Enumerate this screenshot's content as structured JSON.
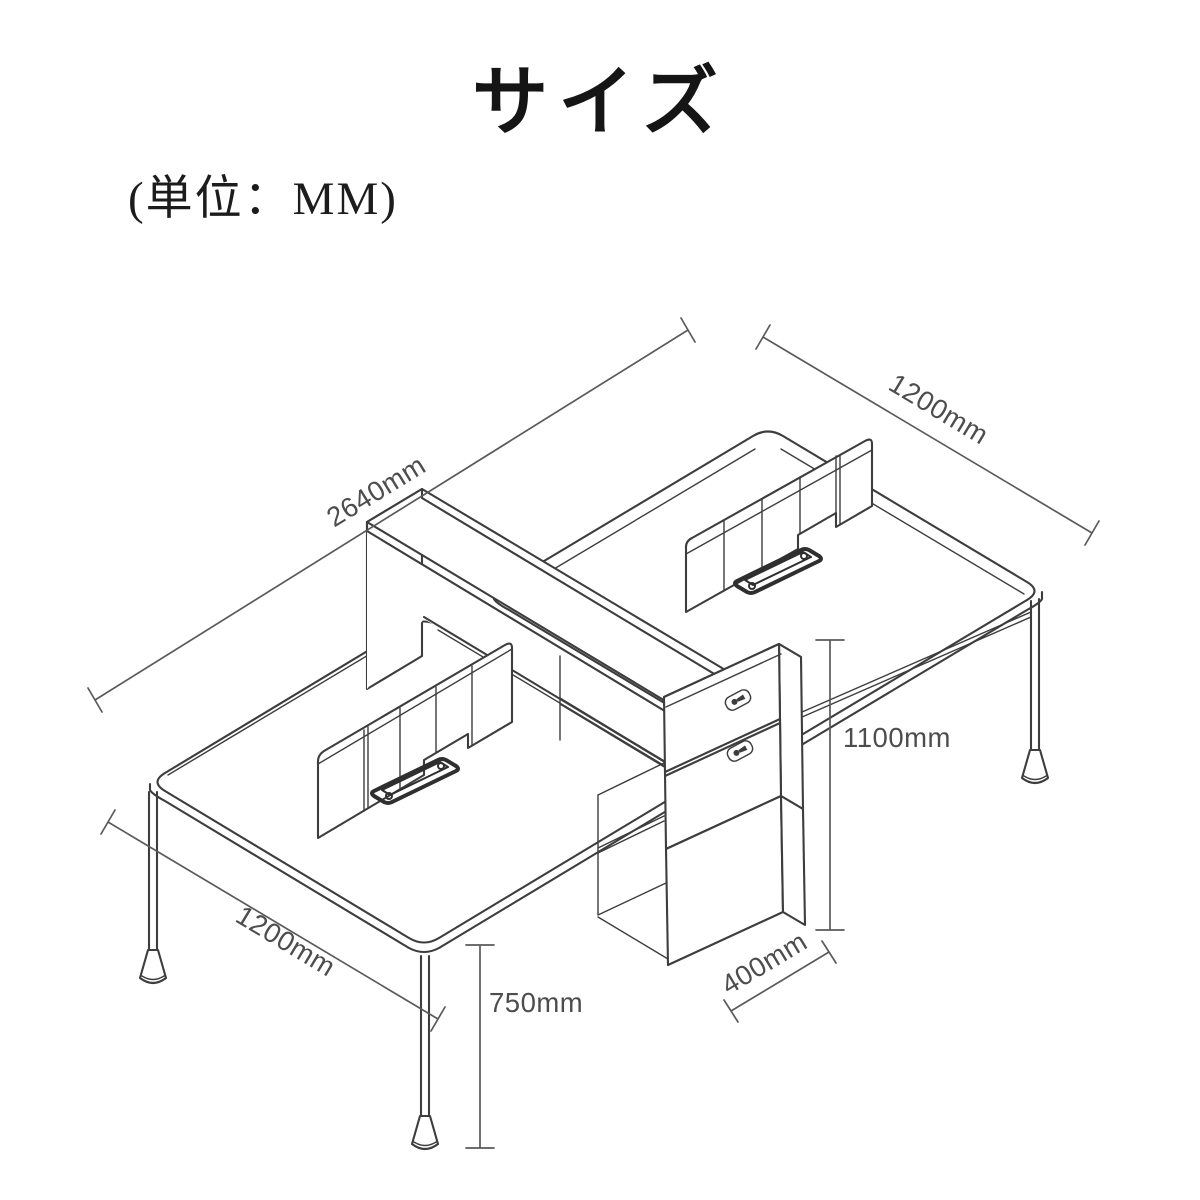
{
  "page": {
    "title": "サイズ",
    "unit_note": "(単位：MM)",
    "background_color": "#ffffff"
  },
  "diagram": {
    "type": "isometric-dimension-drawing",
    "subject": "Two-sided office workstation: two desktops with center privacy screens and cable trays, shared shelf spine with hutch top, two-drawer pedestal with floor cabinet, slim tapered legs",
    "line_color": "#3d3d3d",
    "dimension_color": "#5a5a5a",
    "dimensions": [
      {
        "id": "overall-length",
        "label": "2640mm",
        "value_mm": 2640,
        "measures": "overall workstation length"
      },
      {
        "id": "right-desk-depth",
        "label": "1200mm",
        "value_mm": 1200,
        "measures": "right desktop depth"
      },
      {
        "id": "left-desk-depth",
        "label": "1200mm",
        "value_mm": 1200,
        "measures": "left desktop depth"
      },
      {
        "id": "overall-height",
        "label": "1100mm",
        "value_mm": 1100,
        "measures": "height to top of center hutch"
      },
      {
        "id": "desk-height",
        "label": "750mm",
        "value_mm": 750,
        "measures": "desktop height"
      },
      {
        "id": "cabinet-width",
        "label": "400mm",
        "value_mm": 400,
        "measures": "floor cabinet width"
      }
    ]
  }
}
